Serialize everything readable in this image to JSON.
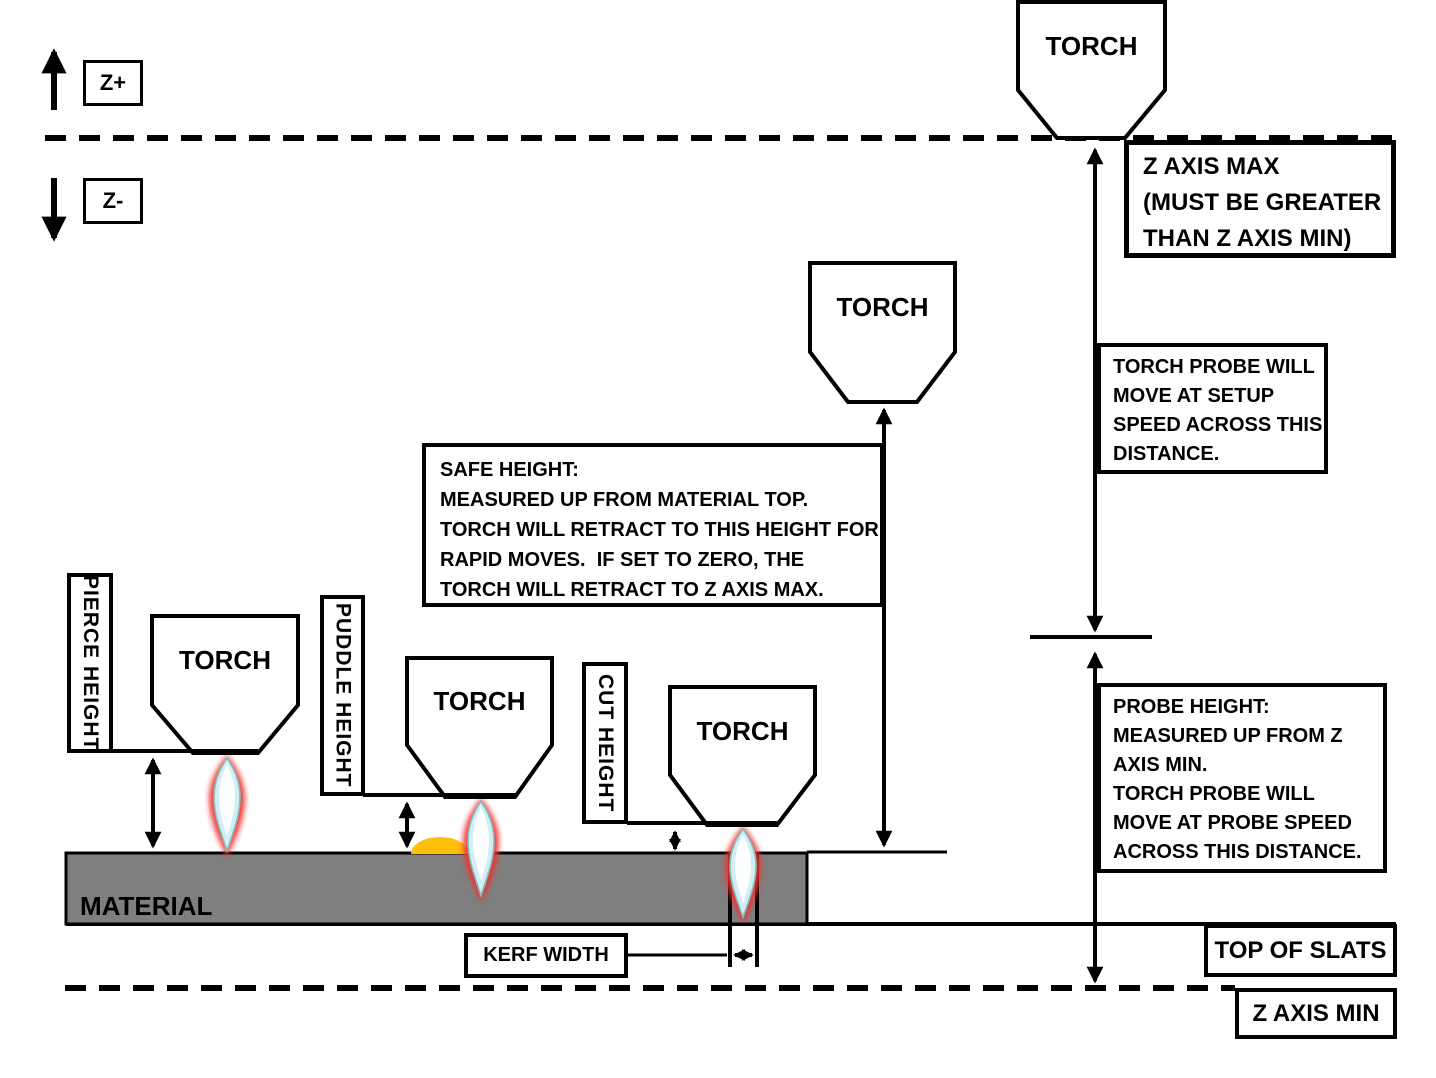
{
  "torch_label": "TORCH",
  "controls": {
    "z_plus": "Z+",
    "z_minus": "Z-"
  },
  "labels": {
    "z_axis_max": [
      "Z AXIS MAX",
      "(MUST BE GREATER",
      "THAN Z AXIS MIN)"
    ],
    "torch_probe": [
      "TORCH PROBE WILL",
      "MOVE AT SETUP",
      "SPEED ACROSS THIS",
      "DISTANCE."
    ],
    "probe_height": [
      "PROBE HEIGHT:",
      "MEASURED UP FROM Z",
      "AXIS MIN.",
      "TORCH PROBE WILL",
      "MOVE AT PROBE SPEED",
      "ACROSS THIS DISTANCE."
    ],
    "safe_height": [
      "SAFE HEIGHT:",
      "MEASURED UP FROM MATERIAL TOP.",
      "TORCH WILL RETRACT TO THIS HEIGHT FOR",
      "RAPID MOVES.  IF SET TO ZERO, THE",
      "TORCH WILL RETRACT TO Z AXIS MAX."
    ],
    "pierce_height": "PIERCE HEIGHT",
    "puddle_height": "PUDDLE HEIGHT",
    "cut_height": "CUT HEIGHT",
    "kerf_width": "KERF WIDTH",
    "material": "MATERIAL",
    "top_of_slats": "TOP OF SLATS",
    "z_axis_min": "Z AXIS MIN"
  },
  "colors": {
    "line": "#000000",
    "material_fill": "#7f7f7f",
    "puddle_fill": "#fdbf0b",
    "flame_outer": "#f2332e",
    "flame_inner": "#cfeef6",
    "flame_core": "#ffffff",
    "background": "#ffffff"
  }
}
